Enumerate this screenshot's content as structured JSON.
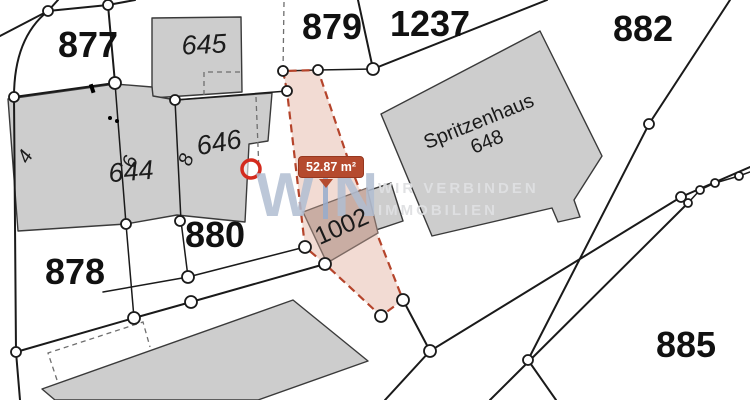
{
  "labels": {
    "p877": "877",
    "p878": "878",
    "p879": "879",
    "p880": "880",
    "p882": "882",
    "p885": "885",
    "p1237": "1237",
    "p1002": "1002"
  },
  "buildings": {
    "b644": "644",
    "b645": "645",
    "b646": "646",
    "spritzenhaus_name": "Spritzenhaus",
    "spritzenhaus_no": "648"
  },
  "house_numbers": {
    "h4": "4",
    "h6": "6",
    "h8": "8"
  },
  "badge": {
    "area": "52.87 m²"
  },
  "watermark": {
    "w": "W",
    "n": "N",
    "tagline1": "WIR VERBINDEN",
    "tagline2": "IMMOBILIEN"
  },
  "colors": {
    "highlight_fill": "rgba(197,90,56,0.22)",
    "highlight_border": "#b5442b",
    "badge_bg": "#b54a2e",
    "building_fill": "#cdcdcd",
    "poi_ring": "#d42b1e"
  }
}
